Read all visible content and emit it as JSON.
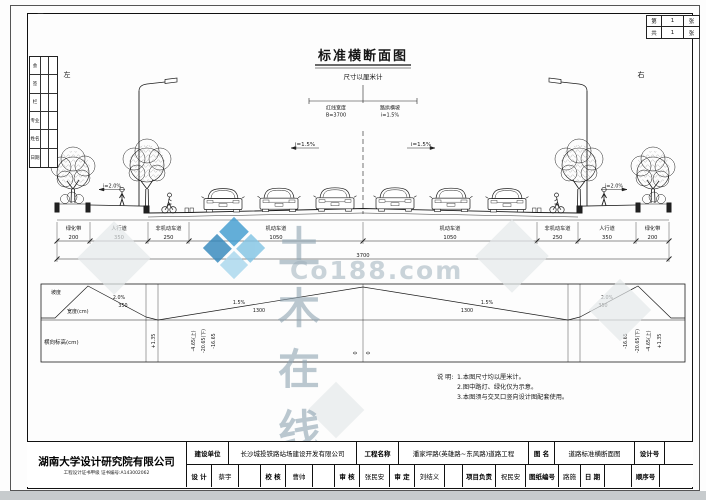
{
  "frame": {
    "left": "左",
    "right": "右",
    "pages": {
      "r1c1": "第",
      "r1c2": "1",
      "r1c3": "张",
      "r2c1": "共",
      "r2c2": "1",
      "r2c3": "张"
    },
    "sign": {
      "rows": [
        "会",
        "签",
        "栏",
        "专业",
        "姓名",
        "日期"
      ]
    }
  },
  "drawing": {
    "title": "标准横断面图",
    "subtitle": "尺寸以厘米计",
    "cl": {
      "l1": "红线宽度",
      "l2": "B=3700",
      "r1": "路拱横坡",
      "r2": "i=1.5%"
    },
    "sec": {
      "slope_motor": "i=1.5%",
      "slope_walk": "i=2.0%",
      "lanes": [
        {
          "label": "绿化带",
          "dim": "200"
        },
        {
          "label": "人行道",
          "dim": "350"
        },
        {
          "label": "非机动车道",
          "dim": "250"
        },
        {
          "label": "机动车道",
          "dim": "1050"
        },
        {
          "label": "机动车道",
          "dim": "1050"
        },
        {
          "label": "非机动车道",
          "dim": "250"
        },
        {
          "label": "人行道",
          "dim": "350"
        },
        {
          "label": "绿化带",
          "dim": "200"
        }
      ],
      "total": "3700"
    },
    "prof": {
      "grade": "坡度",
      "width": "宽度(cm)",
      "elev": "横向标高(cm)",
      "seg": [
        {
          "slope": "2.0%",
          "width": "350"
        },
        {
          "slope": "1.5%",
          "width": "1300"
        },
        {
          "slope": "1.5%",
          "width": "1300"
        },
        {
          "slope": "2.0%",
          "width": "350"
        }
      ],
      "elevs": [
        "+1.35",
        "-4.65(上)",
        "-20.65(下)",
        "-16.65",
        "0",
        "0",
        "-16.65",
        "-20.65(下)",
        "-4.65(上)",
        "+1.35"
      ]
    },
    "notes": {
      "head": "说 明:",
      "l1": "1.本图尺寸均以厘米计。",
      "l2": "2.图中路灯、绿化仅为示意。",
      "l3": "3.本图须与交叉口竖向设计图配套使用。"
    }
  },
  "watermark": {
    "cn": "土木在线",
    "en": "Co188.com"
  },
  "tb": {
    "company": "湖南大学设计研究院有限公司",
    "cert": "工程设计证书甲级 证书编号:A143002062",
    "owner_label": "建设单位",
    "owner": "长沙城投铁路站场建设开发有限公司",
    "project_label": "工程名称",
    "project": "潘家坪路(英雄路~东风路)道路工程",
    "dwg_label": "图 名",
    "dwg": "道路标准横断面图",
    "designno_label": "设计号",
    "design_label": "设 计",
    "design": "蔡宇",
    "check_label": "校 核",
    "check": "曹帅",
    "review_label": "审 核",
    "review": "张民安",
    "approve_label": "审 定",
    "approve": "刘结义",
    "pm_label": "项目负责",
    "pm": "祝民安",
    "sheet_label": "图纸编号",
    "sheet": "路施",
    "date_label": "日 期",
    "seq_label": "顺序号"
  }
}
